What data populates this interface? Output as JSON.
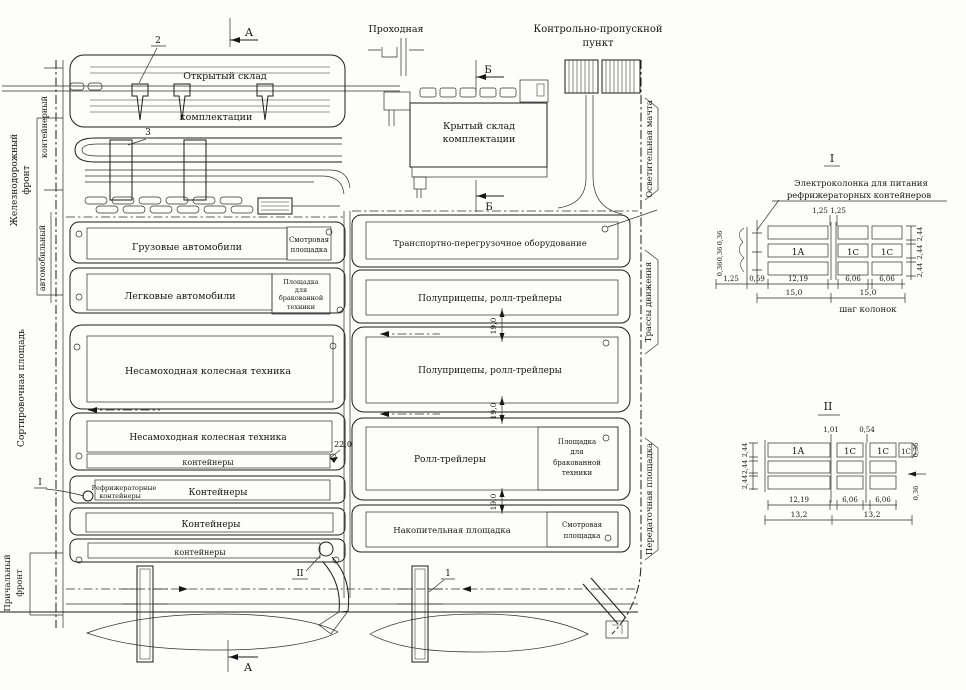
{
  "plan": {
    "left_edge": {
      "container": "контейнерный",
      "railway_front": [
        "Железнодорожный",
        "фронт"
      ],
      "automobile": "автомобильный",
      "sorting_area": "Сортировочная площадь",
      "berth_front": [
        "Причальный",
        "фронт"
      ]
    },
    "right_edge": {
      "lighting_mast": "Осветительная мачта",
      "traffic_routes": "Трассы движения",
      "transfer_area": "Передаточная площадка"
    },
    "top": {
      "gatehouse": "Проходная",
      "checkpoint": [
        "Контрольно-пропускной",
        "пункт"
      ]
    },
    "warehouses": {
      "open": [
        "Открытый склад",
        "комплектации"
      ],
      "covered": [
        "Крытый склад",
        "комплектации"
      ]
    },
    "markers": {
      "section_a": "А",
      "section_b": "Б",
      "c1": "1",
      "c2": "2",
      "c3": "3",
      "roman1": "I",
      "roman2": "II"
    },
    "left_blocks": {
      "trucks": "Грузовые автомобили",
      "inspection": [
        "Смотровая",
        "площадка"
      ],
      "cars": "Легковые автомобили",
      "rejected": [
        "Площадка",
        "для",
        "бракованной",
        "техники"
      ],
      "wheeled1": "Несамоходная колесная техника",
      "wheeled2": "Несамоходная колесная техника",
      "containers_small1": "контейнеры",
      "reefer": [
        "Рефрижераторные",
        "контейнеры"
      ],
      "containers1": "Контейнеры",
      "containers2": "Контейнеры",
      "containers_small2": "контейнеры"
    },
    "right_blocks": {
      "handling": "Транспортно-перегрузочное оборудование",
      "semitrailers1": "Полуприцепы, ролл-трейлеры",
      "semitrailers2": "Полуприцепы, ролл-трейлеры",
      "rolltrailers": "Ролл-трейлеры",
      "rejected": [
        "Площадка",
        "для",
        "бракованной",
        "техники"
      ],
      "accumulation": "Накопительная площадка",
      "inspection": [
        "Смотровая",
        "площадка"
      ]
    },
    "dims": {
      "road22": "22,0",
      "road19": "19,0"
    }
  },
  "detail1": {
    "title": "I",
    "caption": [
      "Электроколонка для питания",
      "рефрижераторных контейнеров"
    ],
    "cells": [
      "1А",
      "1С",
      "1С"
    ],
    "top_dims": [
      "1,25",
      "1,25"
    ],
    "left_dims": [
      "0,36",
      "0,36",
      "0,36"
    ],
    "right_dims": [
      "2,44",
      "2,44",
      "2,44"
    ],
    "bottom_dims1": [
      "1,25",
      "0,59",
      "12,19",
      "6,06",
      "6,06"
    ],
    "bottom_dims2": [
      "15,0",
      "15,0"
    ],
    "note": "шаг колонок"
  },
  "detail2": {
    "title": "II",
    "cells": [
      "1А",
      "1С",
      "1С",
      "1С"
    ],
    "top_dims": [
      "1,01",
      "0,54"
    ],
    "left_dims": [
      "2,44",
      "2,44",
      "2,44"
    ],
    "right_dims": [
      "0,36",
      "0,36"
    ],
    "bottom_dims1": [
      "12,19",
      "6,06",
      "6,06"
    ],
    "bottom_dims2": [
      "13,2",
      "13,2"
    ]
  }
}
